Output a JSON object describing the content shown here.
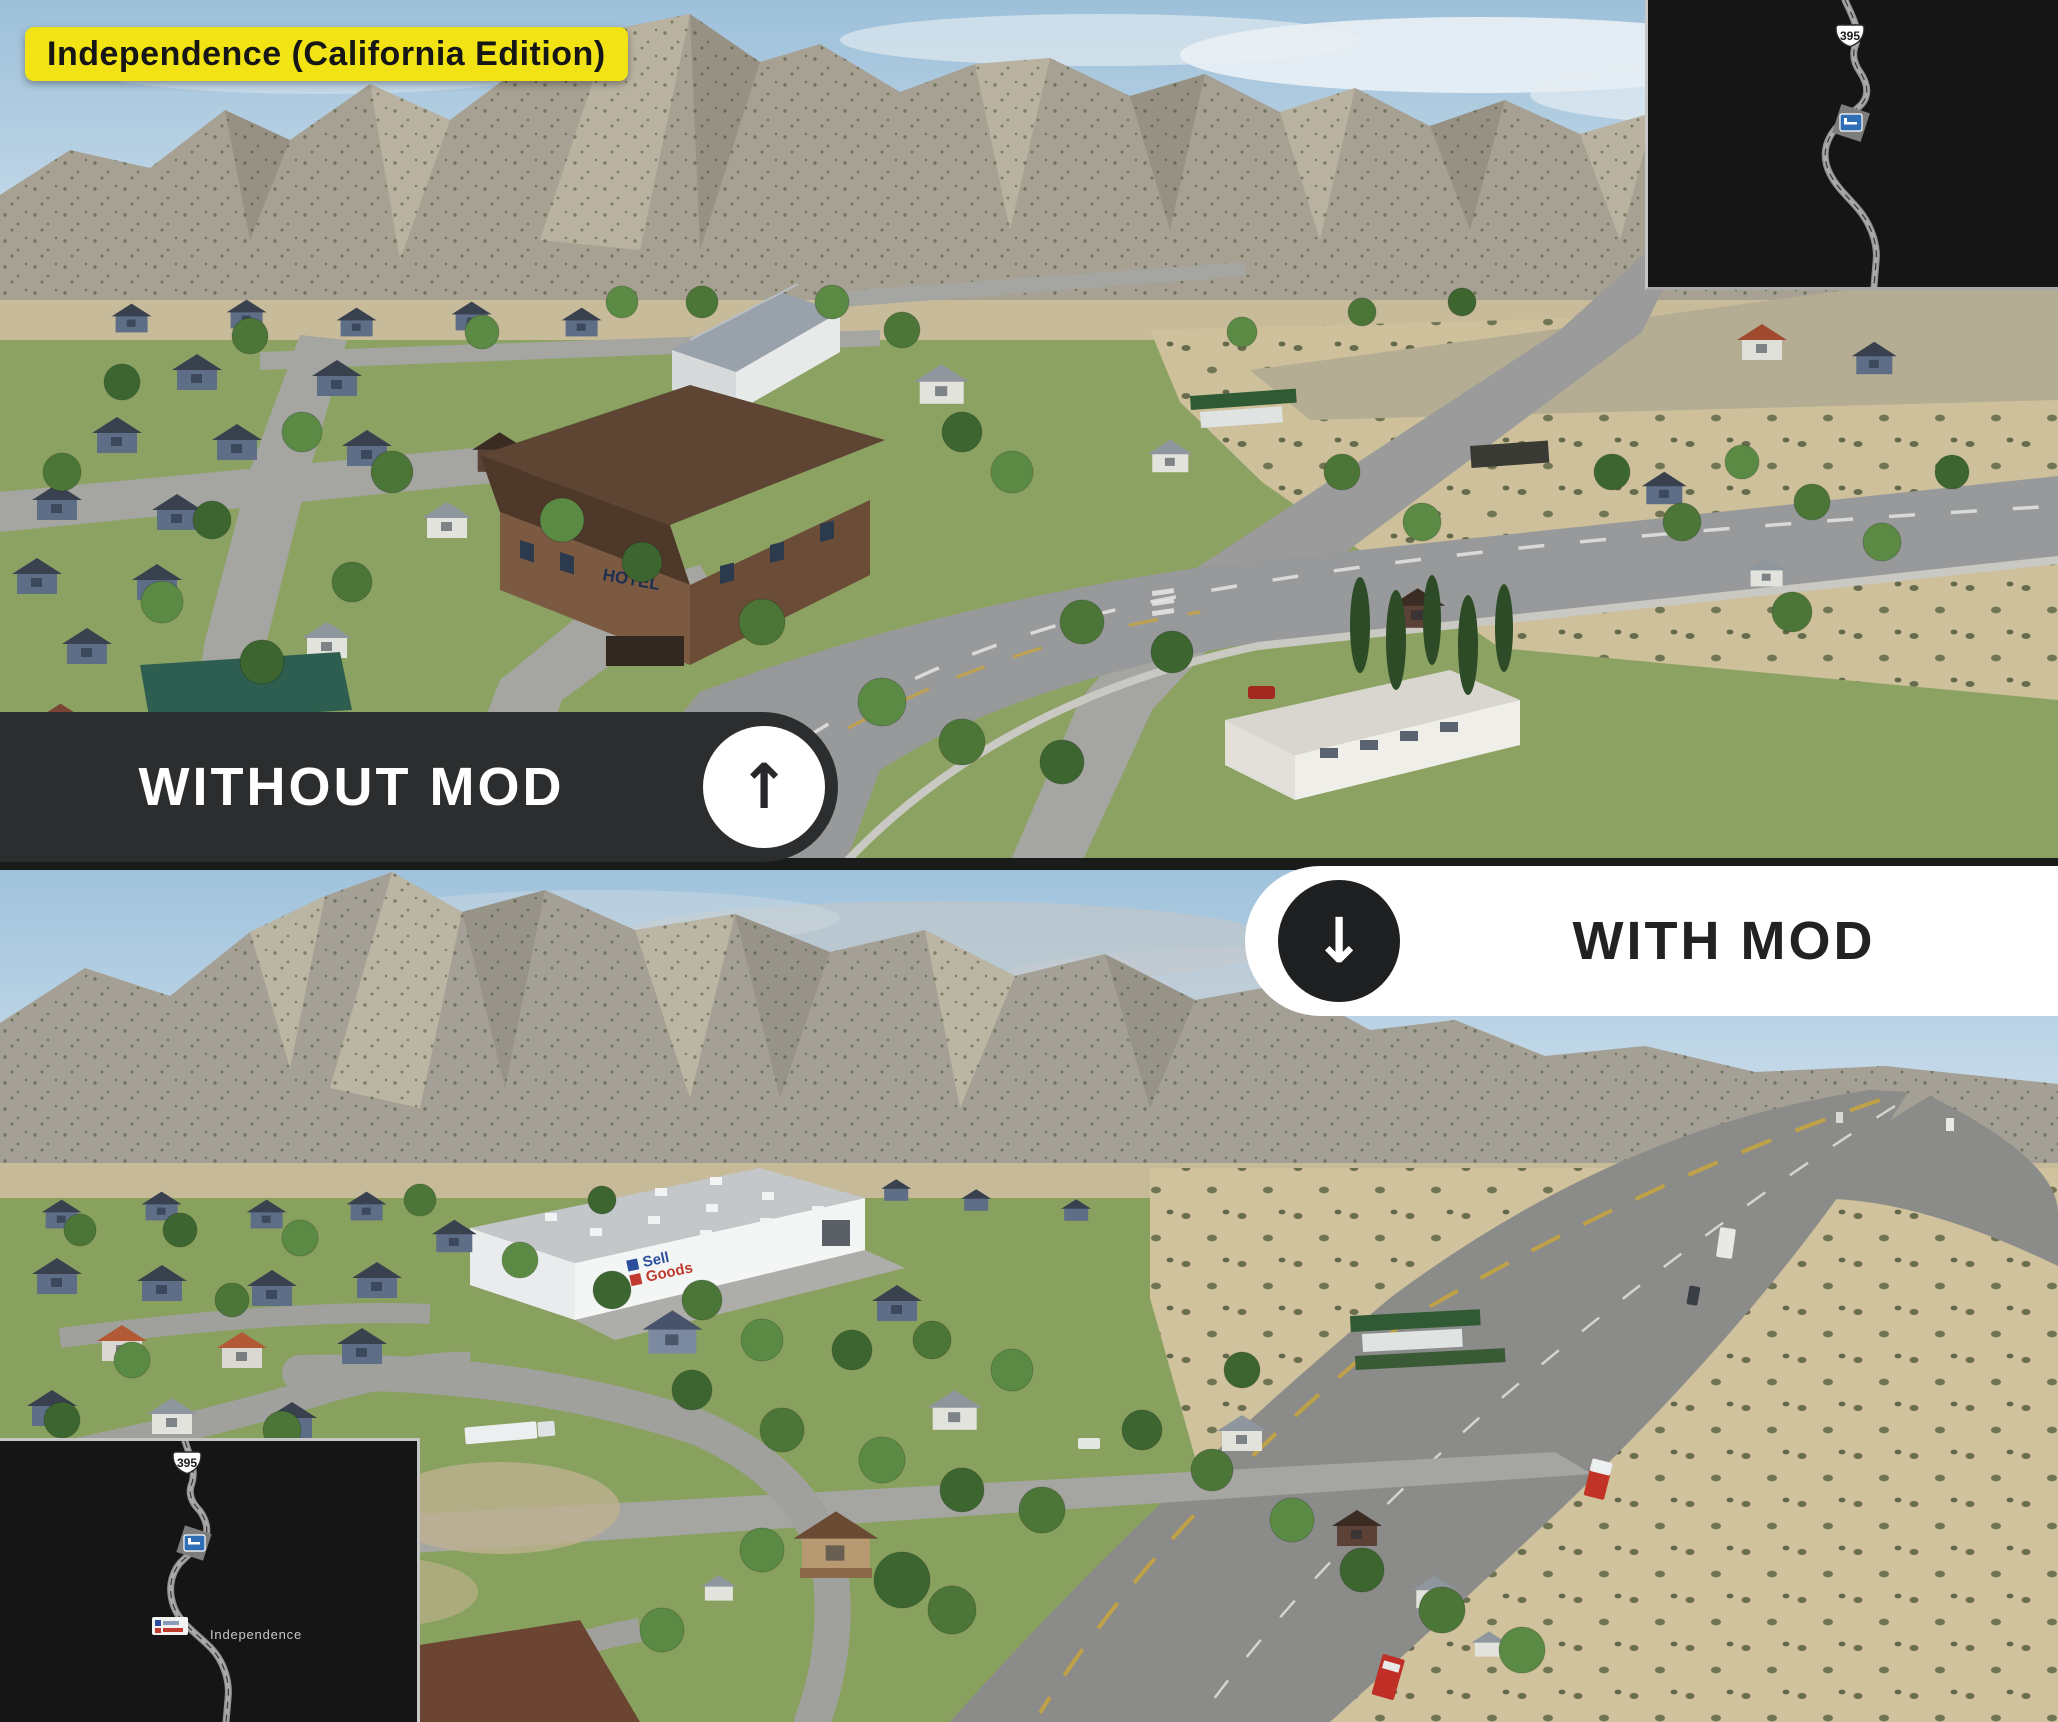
{
  "title_badge": {
    "label": "Independence (California Edition)"
  },
  "banners": {
    "without_mod": {
      "label": "WITHOUT MOD",
      "arrow_icon": "up-arrow",
      "arrow_glyph": "↑"
    },
    "with_mod": {
      "label": "WITH MOD",
      "arrow_icon": "down-arrow",
      "arrow_glyph": "↓"
    }
  },
  "minimaps": {
    "top_right": {
      "route_shield": "395"
    },
    "bottom_left": {
      "route_shield": "395",
      "city_label": "Independence"
    }
  },
  "scene_without_mod": {
    "hotel_sign": "HOTEL"
  },
  "scene_with_mod": {
    "warehouse_logo": {
      "line1": "Sell",
      "line2": "Goods"
    }
  },
  "colors": {
    "badge_bg": "#f2e414",
    "badge_text": "#161616",
    "banner_dark": "#2b2d2e",
    "banner_light": "#ffffff",
    "sky": "#a3c4dd",
    "mountain": "#a49e91",
    "foothill": "#c7bb99",
    "grass": "#88a05f",
    "desert": "#cec19b",
    "asphalt": "#969694",
    "minimap_bg": "#151515",
    "minimap_road": "#8f8f8f",
    "rest_marker_blue": "#2f6db5",
    "truck_red": "#c0332a",
    "logo_blue": "#2b4d9e",
    "logo_red": "#c03a2e"
  }
}
